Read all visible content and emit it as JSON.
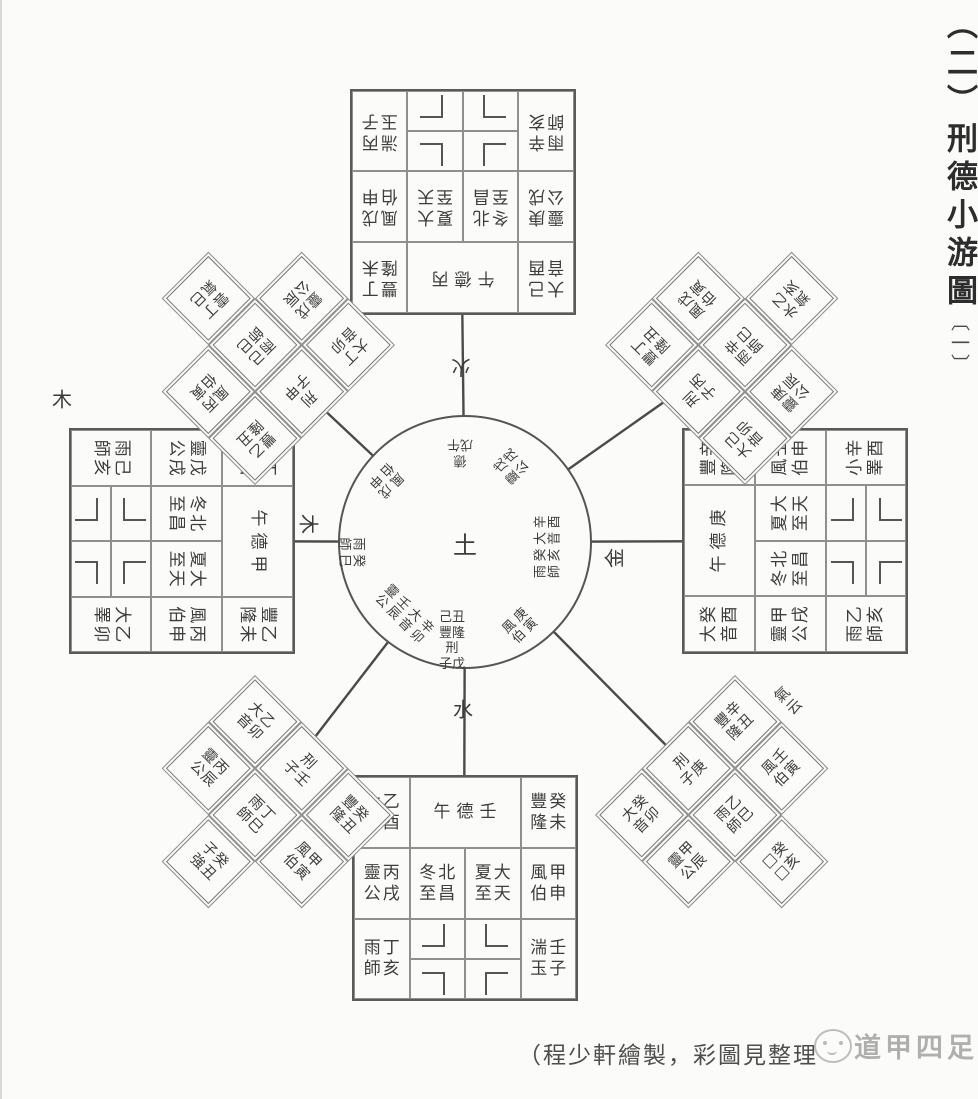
{
  "title": {
    "index": "（二）",
    "main": "刑德小游圖",
    "part": "〔一〕"
  },
  "caption": "（程少軒繪製，彩圖見整理",
  "watermark": {
    "text": "道甲四足"
  },
  "center_circle": {
    "center": "土"
  },
  "element_labels": {
    "north": "火",
    "east": "金",
    "south": "水",
    "west": "木",
    "west_outer": "木"
  },
  "squares": {
    "top": {
      "de": "午德丙",
      "tl": {
        "d": "大音",
        "g": "己酉"
      },
      "tr": {
        "d": "豐隆",
        "g": "丁未"
      },
      "ml": {
        "d": "靈公",
        "g": "庚戌"
      },
      "mc1": {
        "d": "冬至",
        "g": "北昌"
      },
      "mc2": {
        "d": "夏至",
        "g": "大天"
      },
      "mr": {
        "d": "風伯",
        "g": "戊申"
      },
      "bl": {
        "d": "雨師",
        "g": "辛亥"
      },
      "br": {
        "d": "湍玉",
        "g": "丙子"
      }
    },
    "right": {
      "de": "午德庚",
      "tl": {
        "d": "大音",
        "g": "癸酉"
      },
      "tr": {
        "d": "豐隆",
        "g": "辛未"
      },
      "ml": {
        "d": "靈公",
        "g": "甲戌"
      },
      "mc1": {
        "d": "冬至",
        "g": "北昌"
      },
      "mc2": {
        "d": "夏至",
        "g": "大天"
      },
      "mr": {
        "d": "風伯",
        "g": "壬申"
      },
      "bl": {
        "d": "雨師",
        "g": "乙亥"
      },
      "br": {
        "d": "小睪",
        "g": "辛酉"
      }
    },
    "bottom": {
      "de": "午德壬",
      "tl": {
        "d": "大音",
        "g": "乙酉"
      },
      "tr": {
        "d": "豐隆",
        "g": "癸未"
      },
      "ml": {
        "d": "靈公",
        "g": "丙戌"
      },
      "mc1": {
        "d": "冬至",
        "g": "北昌"
      },
      "mc2": {
        "d": "夏至",
        "g": "大天"
      },
      "mr": {
        "d": "風伯",
        "g": "甲申"
      },
      "bl": {
        "d": "雨師",
        "g": "丁亥"
      },
      "br": {
        "d": "湍玉",
        "g": "壬子"
      }
    },
    "left": {
      "de": "午德甲",
      "tl": {
        "d": "大音",
        "g": "丁酉"
      },
      "tr": {
        "d": "豐隆",
        "g": "乙未"
      },
      "ml": {
        "d": "靈公",
        "g": "戊戌"
      },
      "mc1": {
        "d": "冬至",
        "g": "北昌"
      },
      "mc2": {
        "d": "夏至",
        "g": "大天"
      },
      "mr": {
        "d": "風伯",
        "g": "丙申"
      },
      "bl": {
        "d": "雨師",
        "g": "己亥"
      },
      "br": {
        "d": "大睪",
        "g": "乙卯"
      }
    }
  },
  "diamonds": {
    "nw": {
      "a1": {
        "d": "大音",
        "g": "丁卯"
      },
      "xing": "刑子甲",
      "a3": {
        "d": "豐隆",
        "g": "乙丑"
      },
      "b1": {
        "d": "靈公",
        "g": "戊辰"
      },
      "b2": {
        "d": "雨師",
        "g": "己巳"
      },
      "b3": {
        "d": "風伯",
        "g": "丙寅"
      },
      "extra": {
        "d": "雲氣",
        "g": "丁巳"
      }
    },
    "ne": {
      "a1": {
        "d": "大音",
        "g": "己卯"
      },
      "xing": "刑子丙",
      "a3": {
        "d": "豐隆",
        "g": "丁丑"
      },
      "b1": {
        "d": "靈公",
        "g": "庚辰"
      },
      "b2": {
        "d": "雨師",
        "g": "辛巳"
      },
      "b3": {
        "d": "風伯",
        "g": "戊寅"
      },
      "extra": {
        "d": "水氣",
        "g": "乙亥"
      }
    },
    "se": {
      "a1": {
        "d": "大音",
        "g": "癸卯"
      },
      "xing": "刑子庚",
      "a3": {
        "d": "豐隆",
        "g": "辛丑"
      },
      "b1": {
        "d": "靈公",
        "g": "甲辰"
      },
      "b2": {
        "d": "雨師",
        "g": "乙巳"
      },
      "b3": {
        "d": "風伯",
        "g": "壬寅"
      },
      "extra": {
        "d": "□□",
        "g": "癸亥"
      },
      "label": "氣云"
    },
    "sw": {
      "a1": {
        "d": "大音",
        "g": "乙卯"
      },
      "xing": "刑子壬",
      "a3": {
        "d": "豐隆",
        "g": "癸丑"
      },
      "b1": {
        "d": "靈公",
        "g": "丙辰"
      },
      "b2": {
        "d": "雨師",
        "g": "丁巳"
      },
      "b3": {
        "d": "風伯",
        "g": "甲寅"
      },
      "extra": {
        "d": "子強",
        "g": "癸丑"
      }
    }
  },
  "circle_texts": {
    "n": [
      "德",
      "戊午"
    ],
    "ne": [
      "戊戌",
      "靈公"
    ],
    "e": [
      "辛酉",
      "大音",
      "癸亥",
      "雨師"
    ],
    "se": [
      "庚寅",
      "風伯"
    ],
    "s": [
      "己丑",
      "豐隆",
      "刑",
      "子戊"
    ],
    "sw": [
      "辛卯",
      "大音",
      "壬辰",
      "靈公"
    ],
    "w": [
      "癸巳",
      "雨師"
    ],
    "nw": [
      "戊申",
      "風伯"
    ]
  }
}
